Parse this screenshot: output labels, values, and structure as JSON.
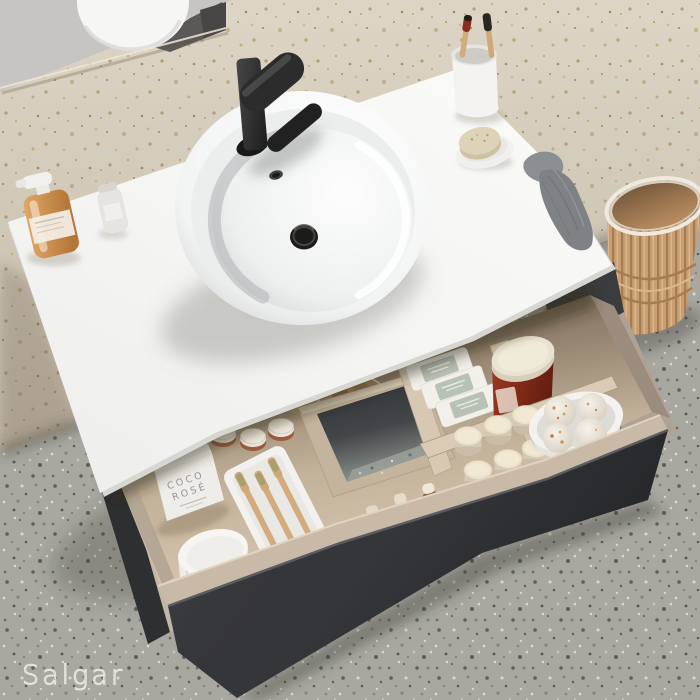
{
  "scene": {
    "description": "Top-down product photo of a bathroom vanity: white countertop with round vessel sink and matte black faucet, open charcoal drawer with birch organizer holding toiletries, beige speckled wall and grey terrazzo floor, rattan waste basket",
    "brand": {
      "logo_text": "Salgar"
    },
    "drawer_items": {
      "box_label_line1": "COCO",
      "box_label_line2": "ROSÉ"
    },
    "palette": {
      "wall_plaster_grey": "#c7c5c2",
      "wall_terrazzo_beige": "#ddd5c5",
      "floor_terrazzo_grey": "#a8a8a1",
      "countertop_white": "#f5f5f3",
      "cabinet_charcoal": "#35363a",
      "drawer_wood_birch": "#c8b79f",
      "faucet_matte_black": "#2c2c2c",
      "dispenser_amber": "#cf9354",
      "cream_jar_red": "#8e2f1d",
      "basket_rattan_tan": "#c89e72",
      "towel_grey": "#8b8f91",
      "toothbrush_bamboo": "#d2ac7c"
    }
  }
}
